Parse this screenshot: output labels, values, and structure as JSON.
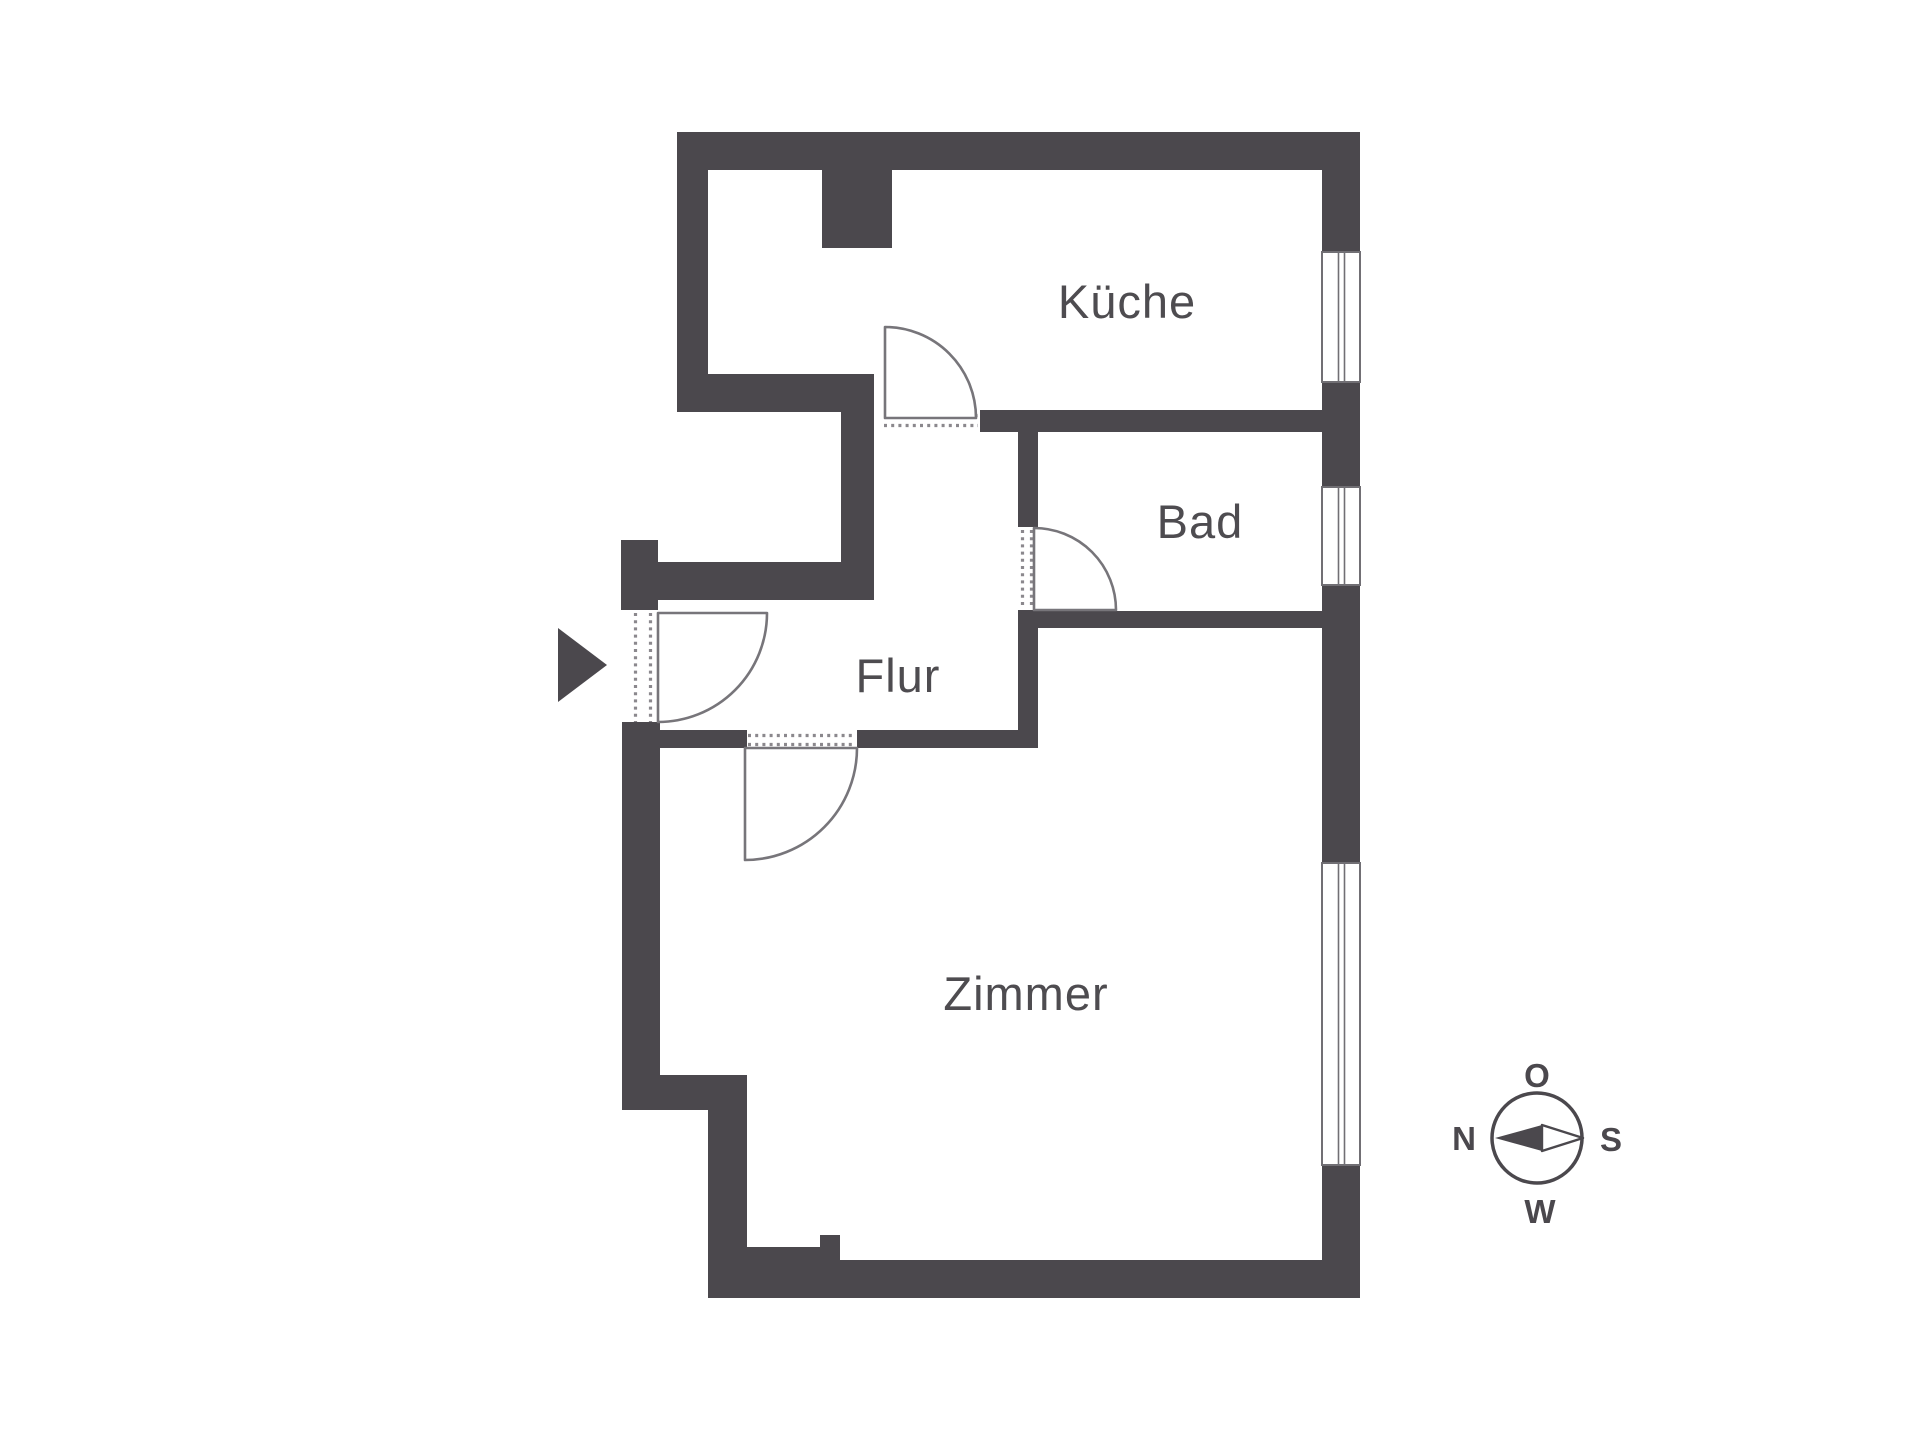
{
  "plan": {
    "rooms": {
      "kueche": {
        "label": "Küche"
      },
      "bad": {
        "label": "Bad"
      },
      "flur": {
        "label": "Flur"
      },
      "zimmer": {
        "label": "Zimmer"
      }
    },
    "colors": {
      "wall": "#4b484d",
      "outline": "#77757a",
      "threshold_dots": "#8b888d",
      "label": "#4e4c50",
      "background": "#ffffff"
    }
  },
  "compass": {
    "top": "O",
    "right": "S",
    "bottom": "W",
    "left": "N"
  }
}
